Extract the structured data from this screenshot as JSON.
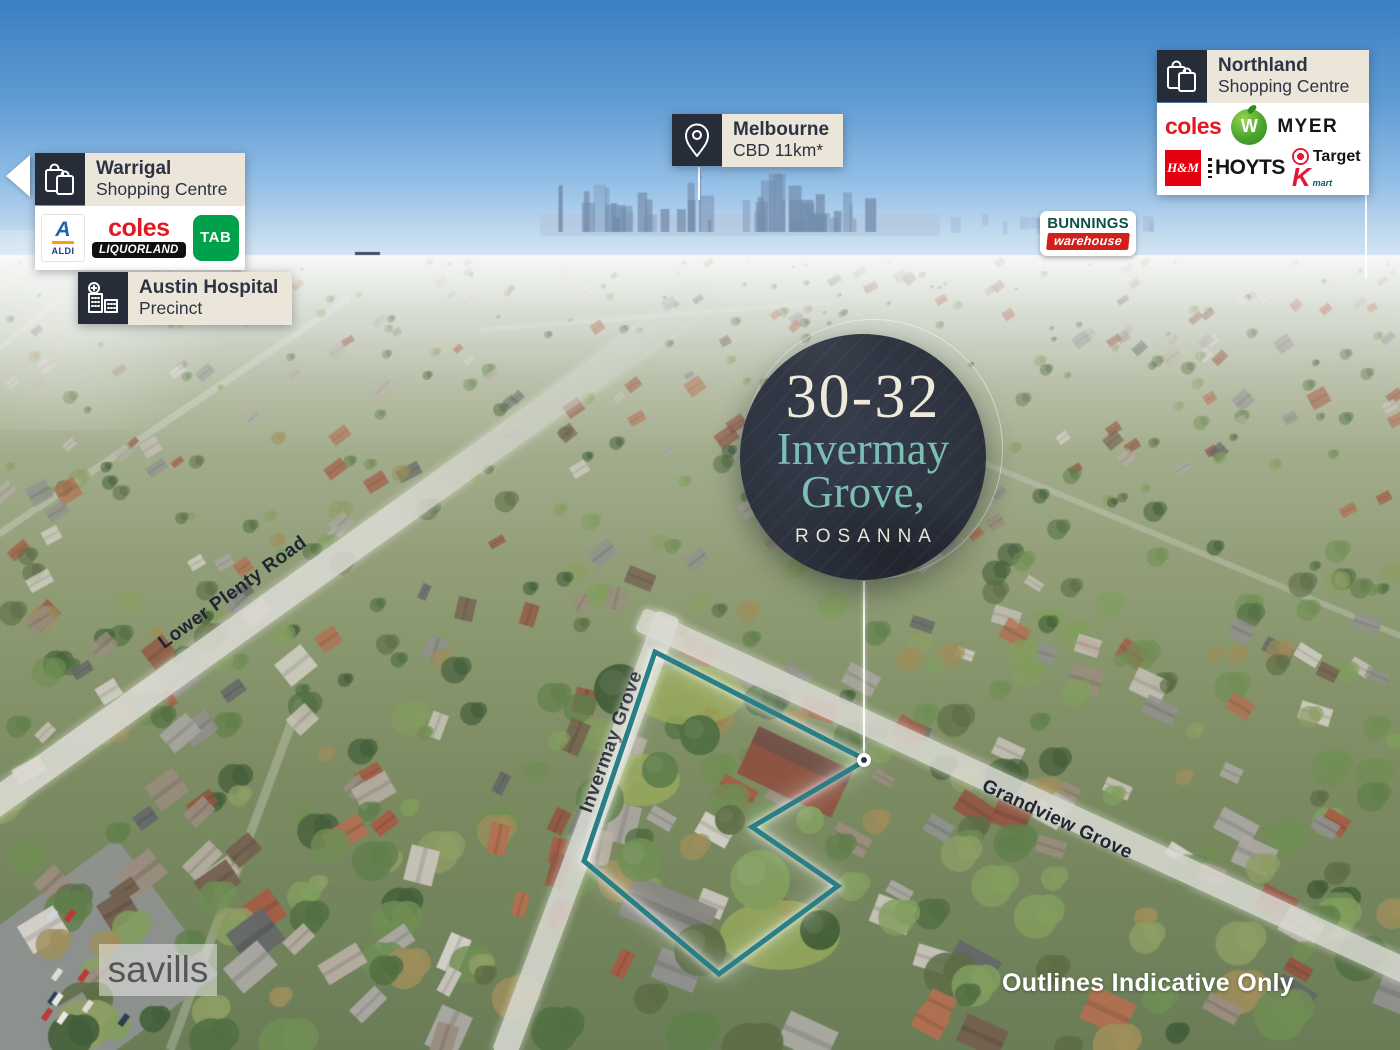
{
  "page": {
    "width": 1400,
    "height": 1050
  },
  "badge": {
    "number": "30-32",
    "street_line1": "Invermay",
    "street_line2": "Grove,",
    "suburb": "ROSANNA"
  },
  "callouts": {
    "warrigal": {
      "title": "Warrigal",
      "subtitle": "Shopping Centre"
    },
    "austin_hospital": {
      "title": "Austin Hospital",
      "subtitle": "Precinct"
    },
    "melbourne_cbd": {
      "title": "Melbourne",
      "subtitle": "CBD 11km*"
    },
    "northland": {
      "title": "Northland",
      "subtitle": "Shopping Centre"
    }
  },
  "logos": {
    "aldi_a": "A",
    "aldi": "ALDI",
    "coles": "coles",
    "liquorland": "LIQUORLAND",
    "tab": "TAB",
    "woolworths_w": "W",
    "myer": "MYER",
    "hm": "H&M",
    "hoyts": "HOYTS",
    "target": "Target",
    "kmart_k": "K",
    "kmart_mart": "mart",
    "bunnings": "BUNNINGS",
    "bunnings_warehouse": "warehouse"
  },
  "roads": {
    "lower_plenty": "Lower Plenty Road",
    "invermay": "Invermay Grove",
    "grandview": "Grandview Grove"
  },
  "watermark": "savills",
  "disclaimer": "Outlines Indicative Only",
  "colors": {
    "outline_teal": "#2a7e85",
    "badge_bg": "#2d333f",
    "badge_cream": "#efe9dc",
    "badge_teal": "#7cbdb6",
    "callout_icon_bg": "#262c38",
    "callout_label_bg": "#ece6da",
    "road_label_text": "#202734",
    "coles_red": "#e01a22",
    "tab_green": "#00a14b",
    "hm_red": "#e50010",
    "target_red": "#e31837",
    "woolworths_green": "#4aa42e",
    "bunnings_green": "#0e4f46",
    "bunnings_red": "#d21f1b"
  }
}
